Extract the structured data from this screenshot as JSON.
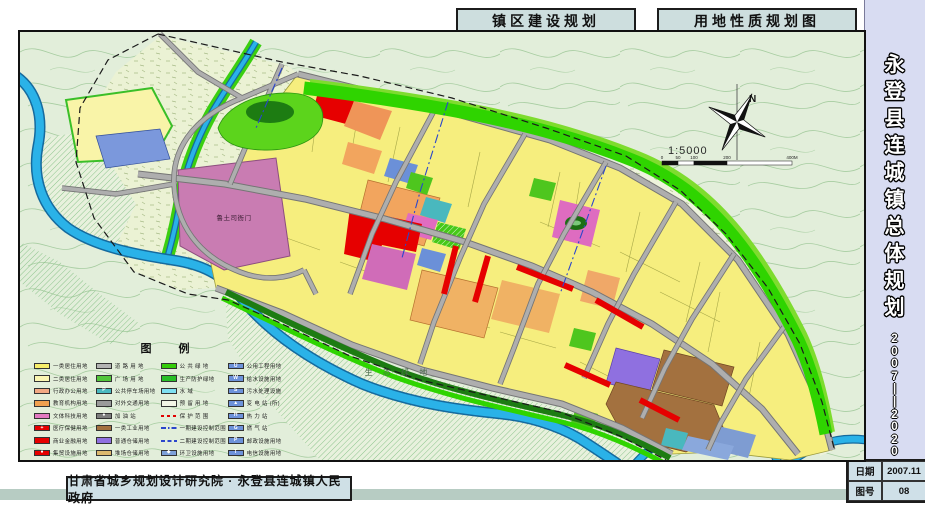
{
  "header": {
    "left_title": "镇区建设规划",
    "right_title": "用地性质规划图"
  },
  "sidebar": {
    "title_chars": [
      "永",
      "登",
      "县",
      "连",
      "城",
      "镇",
      "总",
      "体",
      "规",
      "划"
    ],
    "year_chars": [
      "2",
      "0",
      "0",
      "7",
      "|",
      "|",
      "2",
      "0",
      "2",
      "0"
    ]
  },
  "footer": {
    "credit": "甘肃省城乡规划设计研究院 · 永登县连城镇人民政府",
    "date_label": "日期",
    "date_value": "2007.11",
    "sheet_label": "图号",
    "sheet_value": "08"
  },
  "map": {
    "labels": {
      "heritage_site": "鲁土司衙门",
      "eco_green": "生 态 绿 地"
    },
    "compass_label": "N",
    "scale": {
      "ratio": "1:5000",
      "bar_labels": [
        "0",
        "50",
        "100",
        "200",
        "400M"
      ]
    },
    "legend": {
      "title": "图 例",
      "columns": [
        {
          "items": [
            {
              "label": "一类居住用地",
              "color": "#f7ee6a"
            },
            {
              "label": "二类居住用地",
              "color": "#fbf6b2"
            },
            {
              "label": "行政办公用地",
              "color": "#f2a883"
            },
            {
              "label": "教育机构用地",
              "color": "#f0a050"
            },
            {
              "label": "文体科技用地",
              "color": "#e279c1"
            },
            {
              "label": "医疗保健用地",
              "color": "#e60000",
              "glyph": "+"
            },
            {
              "label": "商业金融用地",
              "color": "#e60000"
            },
            {
              "label": "集贸设施用地",
              "color": "#e60000",
              "glyph": "●"
            }
          ]
        },
        {
          "items": [
            {
              "label": "道 路 用 地",
              "color": "#b3b3b3"
            },
            {
              "label": "广 场 用 地",
              "color": "#52c63a",
              "hatch": "white"
            },
            {
              "label": "公共停车场用地",
              "color": "#49b9c0",
              "glyph": "P"
            },
            {
              "label": "对外交通用地",
              "color": "#9a9a9a"
            },
            {
              "label": "加 油 站",
              "color": "#7d7d7d",
              "glyph": "●"
            },
            {
              "label": "一类工业用地",
              "color": "#a3713f"
            },
            {
              "label": "普通仓储用地",
              "color": "#8f70e0"
            },
            {
              "label": "堆场仓储用地",
              "color": "#dcb96e"
            }
          ]
        },
        {
          "items": [
            {
              "label": "公 共 绿 地",
              "color": "#35cc0a"
            },
            {
              "label": "生产防护绿地",
              "color": "#27bf27"
            },
            {
              "label": "水    域",
              "color": "#7ee0f2"
            },
            {
              "label": "预 留 用 地",
              "color": "#f2f5e6",
              "hatch": "gray"
            },
            {
              "label": "保 护 范 围",
              "type": "line-red"
            },
            {
              "label": "一期建设控制范围",
              "type": "line-bluedd"
            },
            {
              "label": "二期建设控制范围",
              "type": "line-blued"
            },
            {
              "label": "环卫设施用地",
              "color": "#7da0d8",
              "glyph": "◆"
            }
          ]
        },
        {
          "items": [
            {
              "label": "公用工程用地",
              "color": "#6d92da",
              "glyph": "U"
            },
            {
              "label": "给水设施用地",
              "color": "#6d92da",
              "glyph": "W"
            },
            {
              "label": "污水处理设施",
              "color": "#6d92da",
              "glyph": "S"
            },
            {
              "label": "变 电 站 (所)",
              "color": "#6d92da",
              "glyph": "▲"
            },
            {
              "label": "热  力  站",
              "color": "#6d92da",
              "glyph": "H"
            },
            {
              "label": "燃  气  站",
              "color": "#6d92da",
              "glyph": "G"
            },
            {
              "label": "邮政设施用地",
              "color": "#6d92da",
              "glyph": "P"
            },
            {
              "label": "电信设施用地",
              "color": "#6d92da",
              "glyph": "T"
            },
            {
              "label": "村镇建设用地界线",
              "color": "#c6cdbb"
            }
          ]
        }
      ]
    }
  },
  "colors": {
    "river": "#2ab2e8",
    "river_edge": "#156a9e",
    "green_belt": "#2fd400",
    "dark_green": "#1d7c12",
    "residential_yellow": "#f6ee7e",
    "commercial_red": "#e60000",
    "industrial_brown": "#a3713f",
    "warehouse_purple": "#8f70e0",
    "culture_pink": "#de6cc0",
    "education_orange": "#f2a55e",
    "road_gray": "#aeaeae",
    "topo_bg": "#e2eeda",
    "title_box_bg": "#cddede",
    "sidebar_bg": "#d8dcf2"
  }
}
